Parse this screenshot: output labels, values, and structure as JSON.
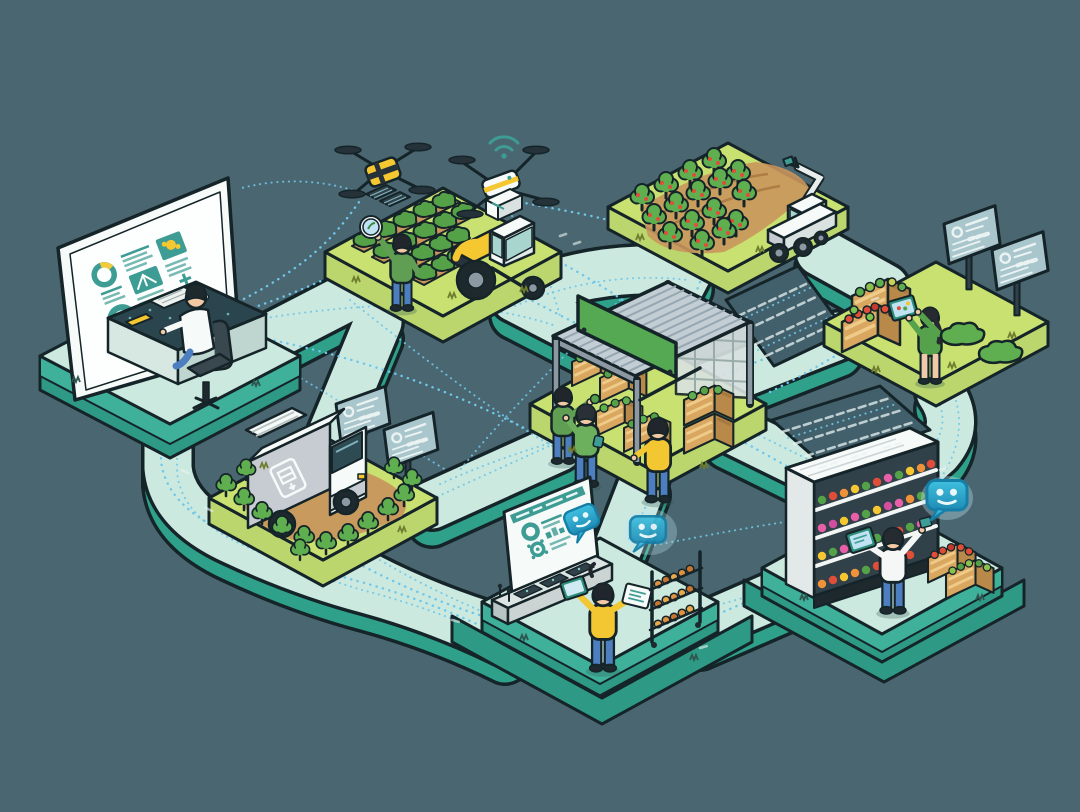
{
  "meta": {
    "title": "Smart agriculture and food supply chain network — isometric illustration",
    "background_color": "#4A6771",
    "canvas": {
      "width": 1080,
      "height": 812
    }
  },
  "palette": {
    "background": "#4A6771",
    "platform_top": "#CCE9E0",
    "platform_side": "#3FB09A",
    "field_top": "#C9E170",
    "field_side": "#BCD66E",
    "soil": "#C9965C",
    "foliage": "#55A147",
    "outline": "#152428",
    "accent_yellow": "#F5C731",
    "data_link_blue": "#6FC6E8",
    "ui_teal": "#3D9C94",
    "chat_bubble_teal": "#2FA8CC",
    "wood_crate": "#D9A75F",
    "denim": "#4D7FC0"
  },
  "scenes": [
    {
      "id": "control-center",
      "label": "Analyst at monitoring desk with large analytics dashboard",
      "elements": [
        "dashboard-screen",
        "donut-charts",
        "desk",
        "office-chair",
        "analyst"
      ]
    },
    {
      "id": "crop-field",
      "label": "Crop field with farmer, tractor and two scouting drones",
      "elements": [
        "crop-rows",
        "farmer-with-inspection-lens",
        "tractor",
        "yellow-quad-drone",
        "white-delivery-drone",
        "wifi-signal"
      ]
    },
    {
      "id": "orchard",
      "label": "Orchard with robotic arm harvester",
      "elements": [
        "fruit-trees",
        "robotic-harvester"
      ]
    },
    {
      "id": "produce-stand",
      "label": "Produce crates checked by worker with tablet beside info screens",
      "elements": [
        "produce-crates",
        "worker-with-tablet",
        "info-screens",
        "shrubs"
      ]
    },
    {
      "id": "market-stall",
      "label": "Covered market stall with blank green sign and crate handlers",
      "elements": [
        "corrugated-canopy",
        "green-sign",
        "crate-stacks",
        "three-workers"
      ]
    },
    {
      "id": "delivery",
      "label": "Delivery box truck driving through trees past tracking screens",
      "elements": [
        "box-truck",
        "trees",
        "tracking-screens"
      ]
    },
    {
      "id": "support-console",
      "label": "Operator at console with AI chatbot bubbles and goods rack",
      "elements": [
        "console-dashboard",
        "chatbot-bubbles",
        "operator-with-tablet",
        "goods-rack"
      ]
    },
    {
      "id": "retail-store",
      "label": "Grocery shelf restocked by clerk with tablet and chatbot assistant",
      "elements": [
        "refrigerated-shelf",
        "clerk-with-tablet",
        "chatbot-bubble",
        "produce-crates"
      ]
    }
  ],
  "connections": {
    "style": "dotted",
    "color": "#6FC6E8",
    "description": "Dotted data links connect every scene across rounded teal walkways"
  },
  "counts": {
    "platforms": 8,
    "drones": 2,
    "chat_bubbles": 3,
    "people": 8,
    "info_screens": 4
  }
}
